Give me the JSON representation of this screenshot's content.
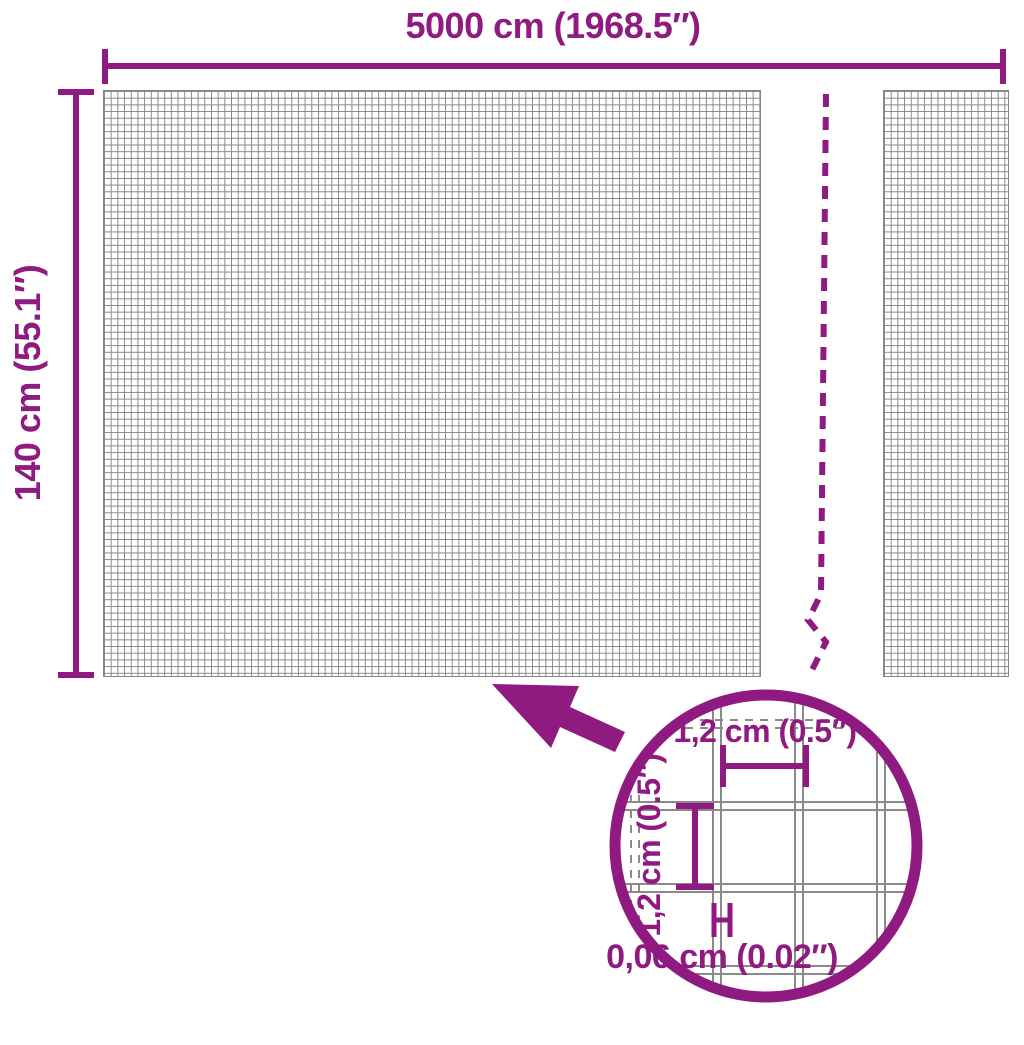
{
  "product_diagram": {
    "total_width_label": "5000 cm (1968.5″)",
    "total_height_label": "140 cm (55.1″)",
    "mesh_detail": {
      "cell_width_label": "1,2 cm (0.5″)",
      "cell_height_label": "1,2 cm (0.5″)",
      "wire_thickness_label": "0,06 cm (0.02″)"
    },
    "colors": {
      "accent_purple": "#8f1a80",
      "mesh_gray": "#868686"
    }
  }
}
